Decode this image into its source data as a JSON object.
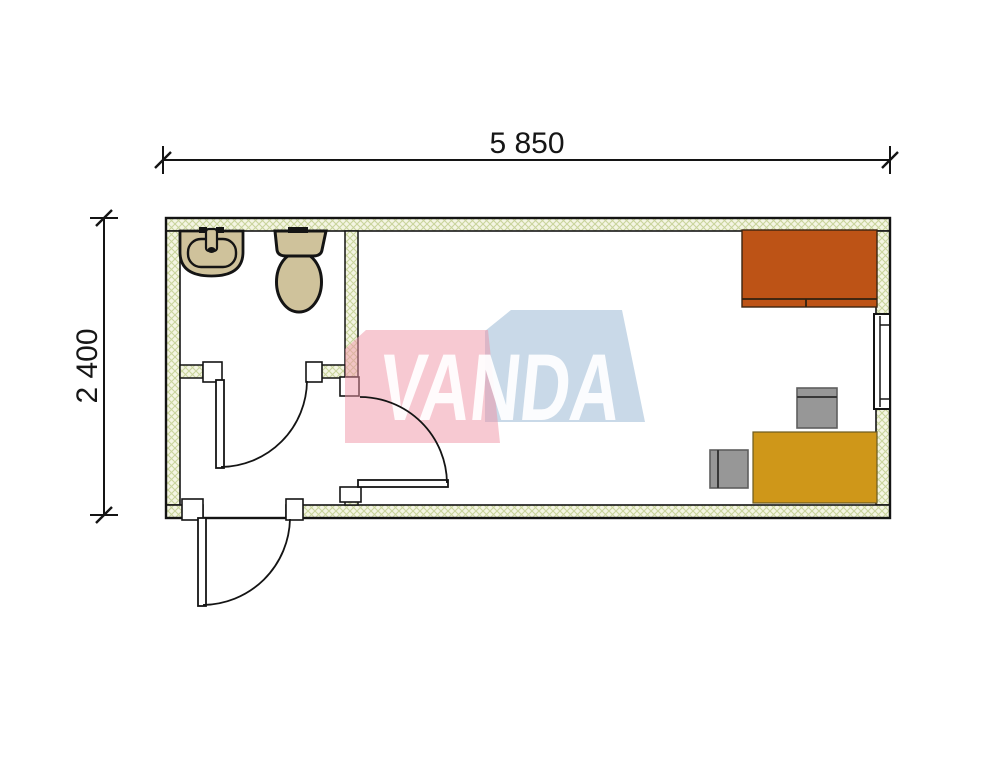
{
  "drawing": {
    "kind": "floor-plan",
    "description": "Single module container office floor plan with WC"
  },
  "dimensions": {
    "width_label": "5 850",
    "height_label": "2 400"
  },
  "watermark": {
    "text": "VANDA",
    "pink": "#ef93a6",
    "blue": "#9dbad6",
    "letter_color": "#ffffff"
  },
  "colors": {
    "wall_fill": "#f4f5e3",
    "wall_line": "#c9d49c",
    "outline": "#141414",
    "fixture": "#cfc29b",
    "cabinet": "#bd5316",
    "desk": "#cf9719",
    "chair": "#979797",
    "chair_edge": "#5e5e5e"
  },
  "objects": [
    {
      "name": "washbasin"
    },
    {
      "name": "toilet"
    },
    {
      "name": "bathroom-door"
    },
    {
      "name": "interior-door"
    },
    {
      "name": "entrance-door"
    },
    {
      "name": "window"
    },
    {
      "name": "cabinet"
    },
    {
      "name": "desk"
    },
    {
      "name": "office-chair-top"
    },
    {
      "name": "office-chair-left"
    }
  ]
}
